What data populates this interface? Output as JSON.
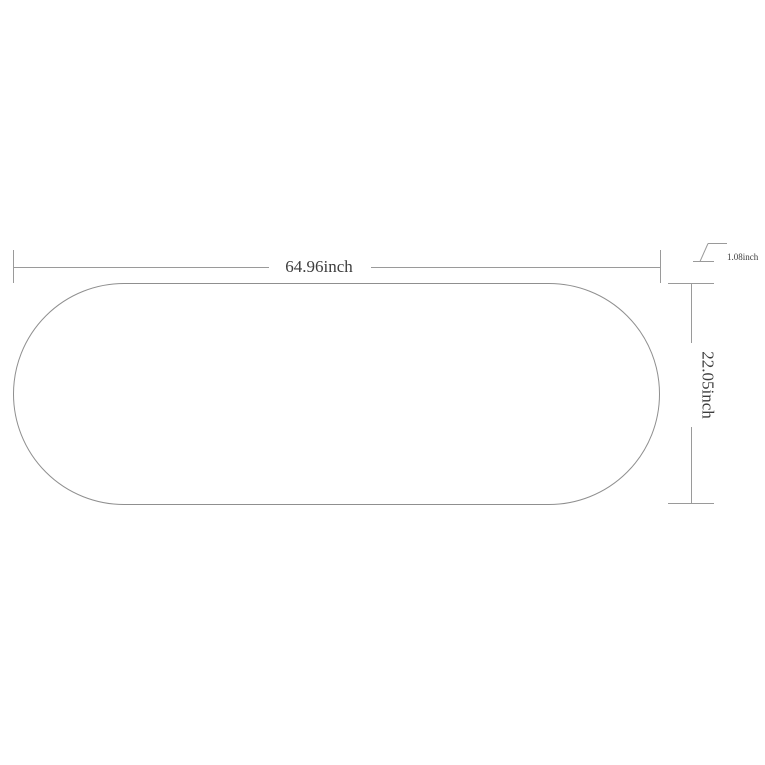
{
  "diagram": {
    "width_dimension": {
      "label": "64.96inch"
    },
    "height_dimension": {
      "label": "22.05inch"
    },
    "thickness_dimension": {
      "label": "1.08inch"
    },
    "colors": {
      "background": "#ffffff",
      "dimension_line": "#9a9a9a",
      "outline": "#8f8f8f",
      "text": "#3d3d3d"
    }
  }
}
